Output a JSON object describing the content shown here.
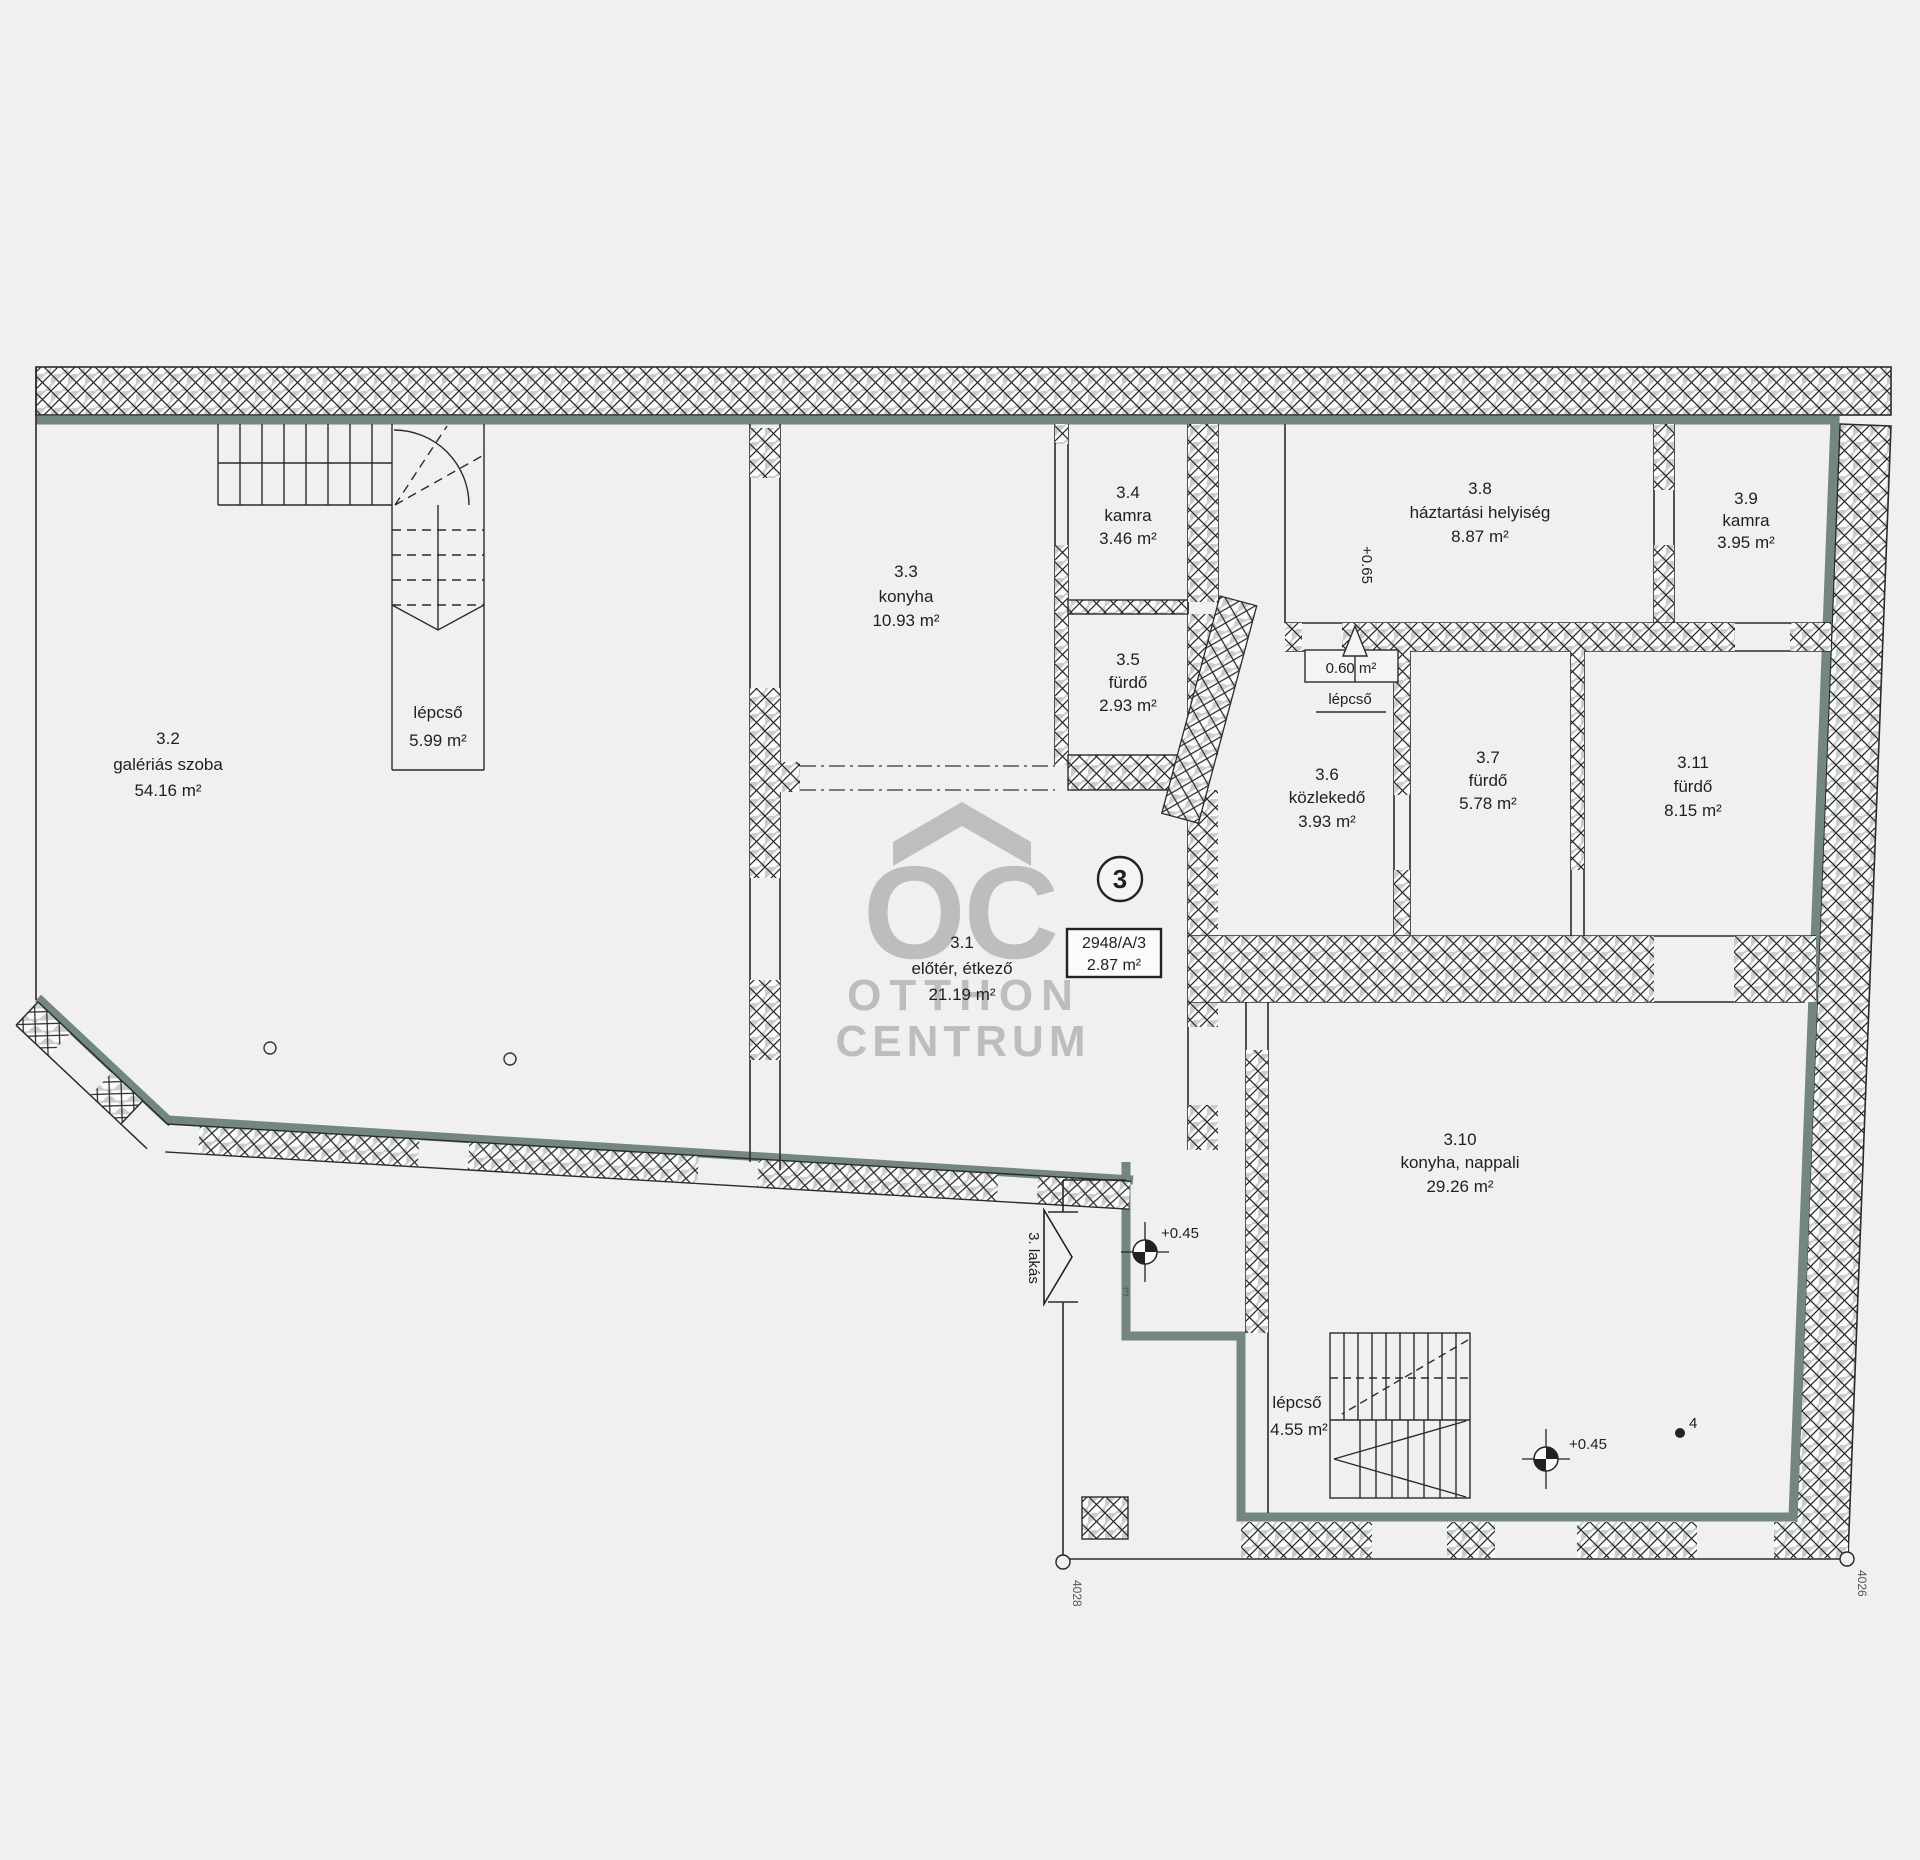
{
  "watermark": {
    "logo": "OC",
    "line1": "OTTHON",
    "line2": "CENTRUM"
  },
  "unit_badge": "3",
  "plate": {
    "lot": "2948/A/3",
    "height": "2.87 m²"
  },
  "rooms": [
    {
      "id": "3.1",
      "name": "előtér, étkező",
      "area": "21.19 m²"
    },
    {
      "id": "3.2",
      "name": "galériás szoba",
      "area": "54.16 m²"
    },
    {
      "id": "3.3",
      "name": "konyha",
      "area": "10.93 m²"
    },
    {
      "id": "3.4",
      "name": "kamra",
      "area": "3.46 m²"
    },
    {
      "id": "3.5",
      "name": "fürdő",
      "area": "2.93 m²"
    },
    {
      "id": "3.6",
      "name": "közlekedő",
      "area": "3.93 m²"
    },
    {
      "id": "3.7",
      "name": "fürdő",
      "area": "5.78 m²"
    },
    {
      "id": "3.8",
      "name": "háztartási helyiség",
      "area": "8.87 m²"
    },
    {
      "id": "3.9",
      "name": "kamra",
      "area": "3.95 m²"
    },
    {
      "id": "3.10",
      "name": "konyha, nappali",
      "area": "29.26 m²"
    },
    {
      "id": "3.11",
      "name": "fürdő",
      "area": "8.15 m²"
    }
  ],
  "stairs": {
    "upper": {
      "label": "lépcső",
      "area": "5.99 m²"
    },
    "lower": {
      "label": "lépcső",
      "area": "4.55 m²"
    },
    "mini": {
      "area": "0.60 m²",
      "label": "lépcső"
    }
  },
  "levels": {
    "entry": "+0.45",
    "living": "+0.45",
    "utility": "+0.65"
  },
  "entrance": {
    "label": "3. lakás"
  },
  "survey": {
    "corner_left": "4028",
    "corner_right": "4026",
    "point4": "4",
    "point3": "3"
  },
  "colors": {
    "accent": "#74877e",
    "paper": "#f0f0ee",
    "ink": "#222222",
    "watermark": "#b5b5b5"
  }
}
